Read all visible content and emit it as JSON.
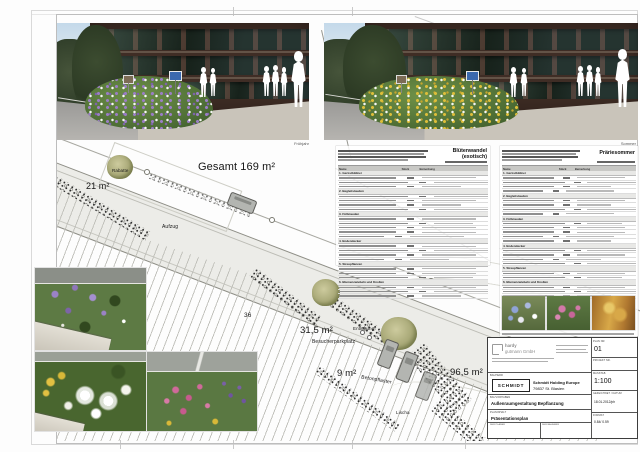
{
  "photos": {
    "left_label": "Frühjahr",
    "right_label": "Sommer"
  },
  "plan": {
    "labels": [
      {
        "text": "Gesamt 169 m²",
        "x": 198,
        "y": 161,
        "size": 11,
        "weight": 400,
        "rot": 0
      },
      {
        "text": "21 m²",
        "x": 86,
        "y": 181,
        "size": 9,
        "weight": 400,
        "rot": 0
      },
      {
        "text": "Rabatte",
        "x": 112,
        "y": 168,
        "size": 4.5,
        "weight": 400,
        "rot": 0
      },
      {
        "text": "Aufzug",
        "x": 162,
        "y": 224,
        "size": 5,
        "weight": 400,
        "rot": 0
      },
      {
        "text": "36",
        "x": 244,
        "y": 312,
        "size": 6.5,
        "weight": 400,
        "rot": 0
      },
      {
        "text": "31,5 m²",
        "x": 300,
        "y": 325,
        "size": 9.5,
        "weight": 400,
        "rot": 0
      },
      {
        "text": "Besucherparkplatz",
        "x": 312,
        "y": 339,
        "size": 5,
        "weight": 400,
        "rot": 0
      },
      {
        "text": "Entlüftung",
        "x": 353,
        "y": 326,
        "size": 4.5,
        "weight": 400,
        "rot": 0
      },
      {
        "text": "9 m²",
        "x": 337,
        "y": 368,
        "size": 9.5,
        "weight": 400,
        "rot": 0
      },
      {
        "text": "Betonpflaster",
        "x": 361,
        "y": 377,
        "size": 5,
        "weight": 400,
        "rot": 10
      },
      {
        "text": "96,5 m²",
        "x": 450,
        "y": 367,
        "size": 9.5,
        "weight": 400,
        "rot": 0
      },
      {
        "text": "Lischa",
        "x": 396,
        "y": 410,
        "size": 4.5,
        "weight": 400,
        "rot": 0
      }
    ]
  },
  "tables": {
    "left": {
      "title": "Blütenwandel (exotisch)",
      "columns": [
        "Name",
        "Stück",
        "Bemerkung"
      ],
      "sections": [
        {
          "label": "1. Gerüstbildner",
          "rows": 3
        },
        {
          "label": "2. Begleitstauden",
          "rows": 4
        },
        {
          "label": "3. Füllstauden",
          "rows": 5
        },
        {
          "label": "4. Bodendecker",
          "rows": 4
        },
        {
          "label": "5. Streupflanzen",
          "rows": 3
        },
        {
          "label": "6. Blumenzwiebeln und Knollen",
          "rows": 3
        }
      ]
    },
    "right": {
      "title": "Präriesommer",
      "columns": [
        "Name",
        "Stück",
        "Bemerkung"
      ],
      "sections": [
        {
          "label": "1. Gerüstbildner",
          "rows": 4
        },
        {
          "label": "2. Begleitstauden",
          "rows": 4
        },
        {
          "label": "3. Füllstauden",
          "rows": 5
        },
        {
          "label": "4. Bodendecker",
          "rows": 4
        },
        {
          "label": "5. Streupflanzen",
          "rows": 2
        },
        {
          "label": "6. Blumenzwiebeln und Knollen",
          "rows": 3
        }
      ]
    }
  },
  "title_block": {
    "firm_name_1": "hardy",
    "firm_name_2": "gutmann GmbH",
    "plan_nr_label": "PLAN NR.",
    "plan_nr": "01",
    "projekt_label": "PROJEKT NR.",
    "bauherr_label": "BAUHERR",
    "client_logo": "SCHMIDT",
    "client_name": "Schmidt Holding Europe",
    "client_city": "79837 St. Blasien",
    "bauvorhaben_label": "BAUVORHABEN",
    "bauvorhaben": "Außenraumgestaltung Bepflanzung",
    "massstab_label": "MASSTAB",
    "massstab": "1:100",
    "planinhalt_label": "PLANINHALT",
    "planinhalt": "Präsentationsplan",
    "gezeichnet_label": "GEZEICHNET / DATUM",
    "gezeichnet": "18.01.2012/ph",
    "format_label": "FORMAT",
    "format": "0.84/ 0.59",
    "planer_label": "DER PLANER",
    "bauherr_sig_label": "DER BAUHERR"
  }
}
